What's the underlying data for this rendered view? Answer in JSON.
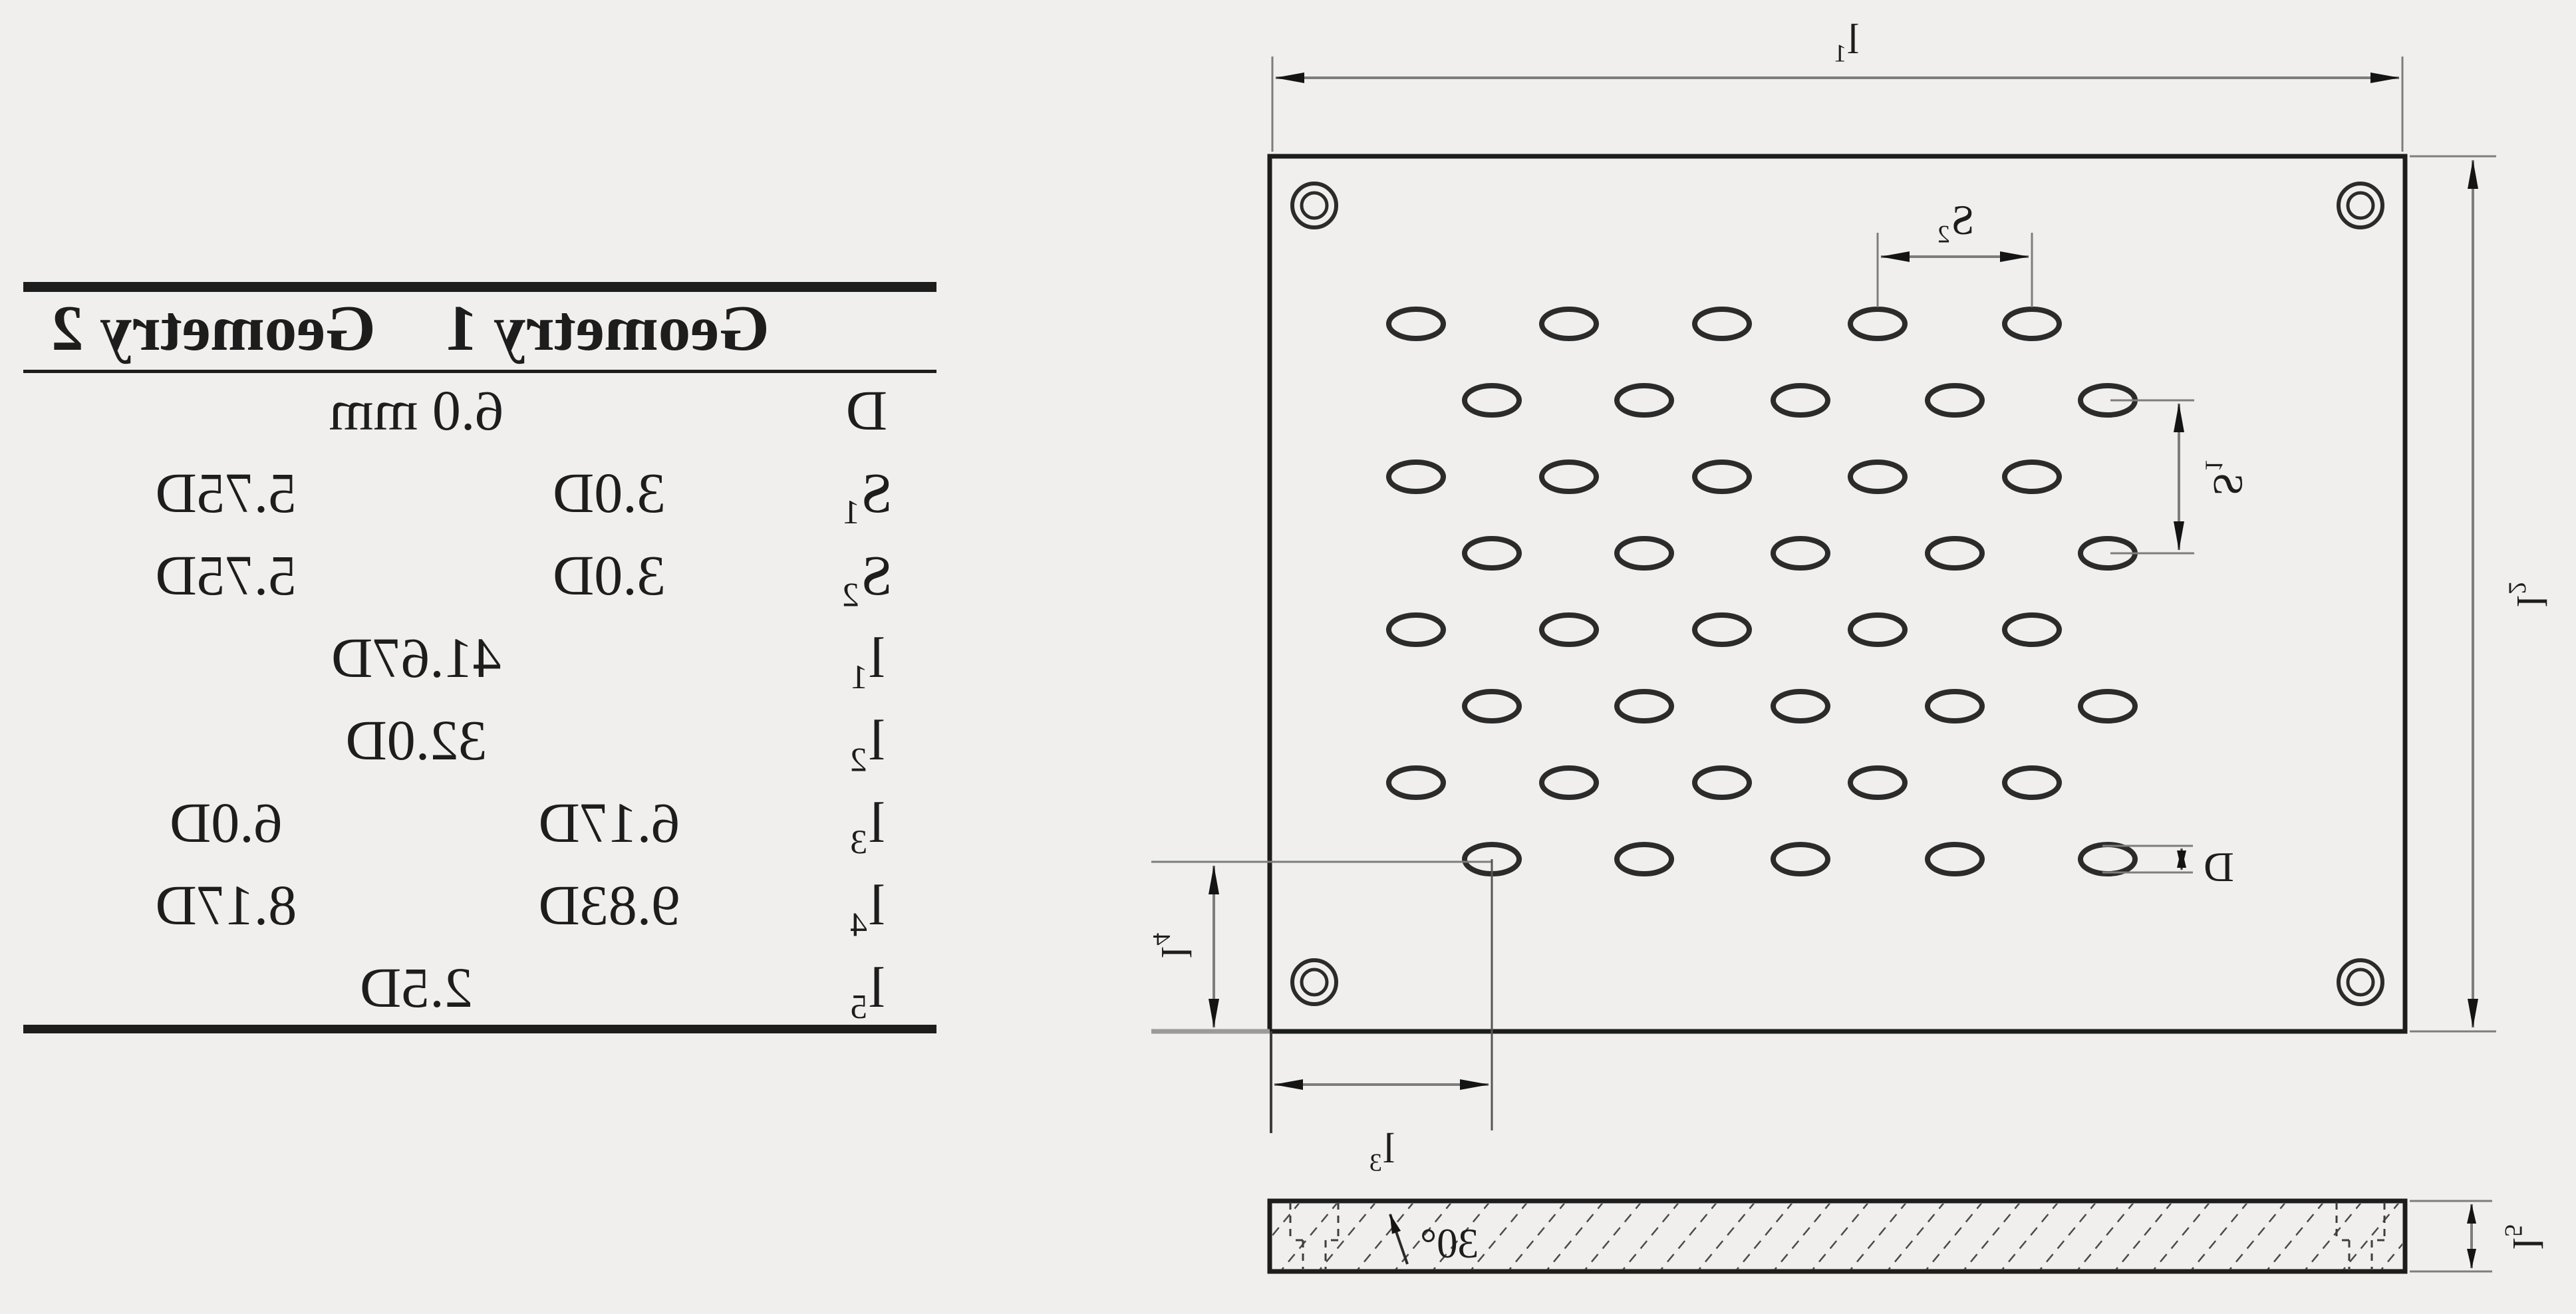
{
  "table": {
    "headers": [
      "Geometry 1",
      "Geometry 2"
    ],
    "rows": [
      {
        "label": "D",
        "span": "6.0 mm"
      },
      {
        "label": "S₁",
        "g1": "3.0D",
        "g2": "5.75D"
      },
      {
        "label": "S₂",
        "g1": "3.0D",
        "g2": "5.75D"
      },
      {
        "label": "l₁",
        "span": "41.67D"
      },
      {
        "label": "l₂",
        "span": "32.0D"
      },
      {
        "label": "l₃",
        "g1": "6.17D",
        "g2": "6.0D"
      },
      {
        "label": "l₄",
        "g1": "9.83D",
        "g2": "8.17D"
      },
      {
        "label": "l₅",
        "span": "2.5D"
      }
    ]
  },
  "diagram": {
    "labels": {
      "plate_width": "l₁",
      "plate_height": "l₂",
      "pitch_horizontal": "S₂",
      "pitch_vertical": "S₁",
      "hole_diameter": "D",
      "edge_offset_horizontal": "l₃",
      "edge_offset_vertical": "l₄",
      "thickness": "l₅",
      "chamfer_angle": "30°"
    }
  },
  "colors": {
    "background": "#f0efed",
    "ink": "#1d1d1d",
    "dim_line": "#7d7d7d"
  }
}
